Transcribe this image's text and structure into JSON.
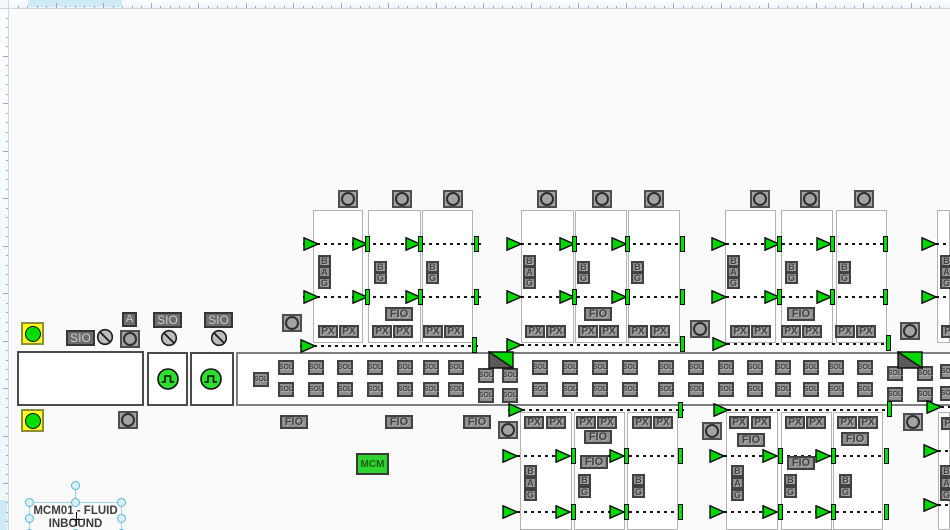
{
  "texts": {
    "sio": "SIO",
    "px": "PX",
    "fio": "FIO",
    "sol": "SOL",
    "mcm": "MCM",
    "a": "A"
  },
  "selected_label": {
    "line1": "MCM01 - FLUID",
    "line2": "INBOUND"
  },
  "colors": {
    "valve_green": "#00d600",
    "bar_green": "#00e000",
    "indicator_yellow": "#ffff1a",
    "box_gray": "#8f8f8f",
    "box_dark": "#414141",
    "ruler_highlight": "#cfe9f7",
    "selection_blue": "#58b7da",
    "mcm_green": "#2fd32f"
  },
  "diagram": {
    "band": [
      236,
      352,
      714,
      54
    ],
    "boxes": [
      [
        17,
        351,
        127,
        55
      ],
      [
        147,
        352,
        41,
        54
      ],
      [
        190,
        352,
        44,
        54
      ]
    ],
    "panels": [
      [
        313,
        210,
        50,
        133
      ],
      [
        368,
        210,
        53,
        133
      ],
      [
        422,
        210,
        51,
        133
      ],
      [
        521,
        210,
        53,
        133
      ],
      [
        575,
        210,
        52,
        133
      ],
      [
        628,
        210,
        52,
        133
      ],
      [
        725,
        210,
        51,
        133
      ],
      [
        781,
        210,
        52,
        133
      ],
      [
        836,
        210,
        51,
        133
      ],
      [
        937,
        210,
        13,
        133
      ],
      [
        520,
        412,
        52,
        118
      ],
      [
        574,
        412,
        51,
        118
      ],
      [
        627,
        412,
        51,
        118
      ],
      [
        726,
        412,
        52,
        118
      ],
      [
        781,
        412,
        51,
        118
      ],
      [
        833,
        412,
        50,
        118
      ],
      [
        938,
        412,
        12,
        118
      ]
    ],
    "dashes": [
      [
        303,
        243,
        178
      ],
      [
        303,
        296,
        178
      ],
      [
        300,
        345,
        180
      ],
      [
        507,
        243,
        178
      ],
      [
        507,
        296,
        178
      ],
      [
        507,
        344,
        178
      ],
      [
        712,
        243,
        176
      ],
      [
        712,
        296,
        176
      ],
      [
        713,
        343,
        177
      ],
      [
        922,
        243,
        28
      ],
      [
        922,
        296,
        28
      ],
      [
        508,
        409,
        176
      ],
      [
        503,
        455,
        180
      ],
      [
        503,
        511,
        180
      ],
      [
        714,
        409,
        178
      ],
      [
        710,
        455,
        180
      ],
      [
        710,
        511,
        180
      ],
      [
        927,
        406,
        23
      ],
      [
        924,
        450,
        26
      ],
      [
        924,
        504,
        26
      ]
    ],
    "triangles": [
      [
        303,
        237
      ],
      [
        352,
        237
      ],
      [
        405,
        237
      ],
      [
        303,
        290
      ],
      [
        352,
        290
      ],
      [
        405,
        290
      ],
      [
        300,
        339
      ],
      [
        506,
        237
      ],
      [
        559,
        237
      ],
      [
        611,
        237
      ],
      [
        506,
        290
      ],
      [
        559,
        290
      ],
      [
        611,
        290
      ],
      [
        506,
        338
      ],
      [
        711,
        237
      ],
      [
        764,
        237
      ],
      [
        816,
        237
      ],
      [
        711,
        290
      ],
      [
        764,
        290
      ],
      [
        816,
        290
      ],
      [
        712,
        337
      ],
      [
        921,
        237
      ],
      [
        921,
        290
      ],
      [
        508,
        403
      ],
      [
        502,
        449
      ],
      [
        555,
        449
      ],
      [
        609,
        449
      ],
      [
        502,
        505
      ],
      [
        555,
        505
      ],
      [
        609,
        505
      ],
      [
        713,
        403
      ],
      [
        709,
        449
      ],
      [
        762,
        449
      ],
      [
        815,
        449
      ],
      [
        709,
        505
      ],
      [
        762,
        505
      ],
      [
        815,
        505
      ],
      [
        926,
        400
      ],
      [
        923,
        444
      ],
      [
        923,
        498
      ]
    ],
    "bars": [
      [
        365,
        236
      ],
      [
        418,
        236
      ],
      [
        474,
        236
      ],
      [
        365,
        289
      ],
      [
        418,
        289
      ],
      [
        474,
        289
      ],
      [
        472,
        337
      ],
      [
        572,
        236
      ],
      [
        625,
        236
      ],
      [
        680,
        236
      ],
      [
        572,
        289
      ],
      [
        625,
        289
      ],
      [
        680,
        289
      ],
      [
        680,
        336
      ],
      [
        777,
        236
      ],
      [
        830,
        236
      ],
      [
        883,
        236
      ],
      [
        777,
        289
      ],
      [
        830,
        289
      ],
      [
        883,
        289
      ],
      [
        886,
        335
      ],
      [
        571,
        448
      ],
      [
        624,
        448
      ],
      [
        678,
        448
      ],
      [
        571,
        504
      ],
      [
        624,
        504
      ],
      [
        678,
        504
      ],
      [
        678,
        402
      ],
      [
        778,
        448
      ],
      [
        831,
        448
      ],
      [
        884,
        448
      ],
      [
        778,
        504
      ],
      [
        831,
        504
      ],
      [
        884,
        504
      ],
      [
        887,
        401
      ]
    ],
    "circle_boxes": [
      [
        338,
        190
      ],
      [
        392,
        190
      ],
      [
        443,
        190
      ],
      [
        537,
        190
      ],
      [
        592,
        190
      ],
      [
        644,
        190
      ],
      [
        750,
        190
      ],
      [
        800,
        190
      ],
      [
        854,
        190
      ],
      [
        282,
        314
      ],
      [
        690,
        320
      ],
      [
        900,
        322
      ],
      [
        498,
        421
      ],
      [
        702,
        422
      ],
      [
        903,
        413
      ],
      [
        120,
        330
      ],
      [
        118,
        411
      ]
    ],
    "crossed_circles": [
      [
        96,
        328
      ],
      [
        160,
        329
      ],
      [
        210,
        329
      ]
    ],
    "yellow_indicators": [
      [
        21,
        322
      ],
      [
        21,
        409
      ]
    ],
    "pulse_indicators": [
      [
        156,
        367
      ],
      [
        199,
        367
      ]
    ],
    "flags": [
      [
        488,
        351
      ],
      [
        897,
        351
      ]
    ],
    "sio_boxes": [
      [
        66,
        330
      ],
      [
        153,
        312
      ],
      [
        204,
        312
      ]
    ],
    "a_boxes": [
      [
        122,
        312
      ]
    ],
    "mcm_boxes": [
      [
        356,
        453
      ]
    ],
    "px_boxes": [
      [
        318,
        325
      ],
      [
        339,
        325
      ],
      [
        372,
        325
      ],
      [
        393,
        325
      ],
      [
        423,
        325
      ],
      [
        444,
        325
      ],
      [
        525,
        325
      ],
      [
        546,
        325
      ],
      [
        578,
        325
      ],
      [
        599,
        325
      ],
      [
        628,
        325
      ],
      [
        650,
        325
      ],
      [
        730,
        325
      ],
      [
        751,
        325
      ],
      [
        781,
        325
      ],
      [
        802,
        325
      ],
      [
        835,
        325
      ],
      [
        856,
        325
      ],
      [
        941,
        325
      ],
      [
        524,
        416
      ],
      [
        546,
        416
      ],
      [
        576,
        416
      ],
      [
        597,
        416
      ],
      [
        632,
        416
      ],
      [
        653,
        416
      ],
      [
        729,
        416
      ],
      [
        751,
        416
      ],
      [
        785,
        416
      ],
      [
        806,
        416
      ],
      [
        837,
        416
      ],
      [
        858,
        416
      ],
      [
        941,
        417
      ]
    ],
    "fio_boxes": [
      [
        385,
        307
      ],
      [
        584,
        307
      ],
      [
        787,
        307
      ],
      [
        584,
        430
      ],
      [
        580,
        455
      ],
      [
        737,
        433
      ],
      [
        841,
        432
      ],
      [
        787,
        456
      ],
      [
        280,
        415
      ],
      [
        385,
        415
      ],
      [
        463,
        415
      ]
    ],
    "sol_boxes": [
      [
        253,
        372
      ],
      [
        278,
        360
      ],
      [
        278,
        382
      ],
      [
        308,
        360
      ],
      [
        308,
        382
      ],
      [
        337,
        360
      ],
      [
        337,
        382
      ],
      [
        367,
        360
      ],
      [
        367,
        382
      ],
      [
        397,
        360
      ],
      [
        397,
        382
      ],
      [
        423,
        360
      ],
      [
        423,
        382
      ],
      [
        448,
        360
      ],
      [
        448,
        382
      ],
      [
        478,
        368
      ],
      [
        478,
        388
      ],
      [
        502,
        368
      ],
      [
        502,
        388
      ],
      [
        532,
        360
      ],
      [
        532,
        382
      ],
      [
        562,
        360
      ],
      [
        562,
        382
      ],
      [
        592,
        360
      ],
      [
        592,
        382
      ],
      [
        622,
        360
      ],
      [
        622,
        382
      ],
      [
        658,
        360
      ],
      [
        658,
        382
      ],
      [
        688,
        360
      ],
      [
        688,
        382
      ],
      [
        718,
        360
      ],
      [
        718,
        382
      ],
      [
        747,
        360
      ],
      [
        747,
        382
      ],
      [
        775,
        360
      ],
      [
        775,
        382
      ],
      [
        803,
        360
      ],
      [
        803,
        382
      ],
      [
        828,
        360
      ],
      [
        828,
        382
      ],
      [
        857,
        360
      ],
      [
        857,
        382
      ],
      [
        887,
        366
      ],
      [
        887,
        387
      ],
      [
        917,
        366
      ],
      [
        917,
        387
      ],
      [
        940,
        364
      ],
      [
        940,
        386
      ]
    ],
    "letters": [
      [
        318,
        255,
        "B"
      ],
      [
        318,
        266,
        "A"
      ],
      [
        318,
        277,
        "G"
      ],
      [
        374,
        261,
        "B"
      ],
      [
        374,
        272,
        "G"
      ],
      [
        426,
        261,
        "B"
      ],
      [
        426,
        272,
        "G"
      ],
      [
        523,
        255,
        "B"
      ],
      [
        523,
        266,
        "A"
      ],
      [
        523,
        277,
        "G"
      ],
      [
        577,
        261,
        "B"
      ],
      [
        577,
        272,
        "G"
      ],
      [
        631,
        261,
        "B"
      ],
      [
        631,
        272,
        "G"
      ],
      [
        727,
        255,
        "B"
      ],
      [
        727,
        266,
        "A"
      ],
      [
        727,
        277,
        "G"
      ],
      [
        785,
        261,
        "B"
      ],
      [
        785,
        272,
        "G"
      ],
      [
        838,
        261,
        "B"
      ],
      [
        838,
        272,
        "G"
      ],
      [
        940,
        255,
        "B"
      ],
      [
        940,
        266,
        "A"
      ],
      [
        940,
        277,
        "G"
      ],
      [
        524,
        465,
        "B"
      ],
      [
        524,
        477,
        "A"
      ],
      [
        524,
        489,
        "G"
      ],
      [
        578,
        474,
        "B"
      ],
      [
        578,
        486,
        "G"
      ],
      [
        632,
        474,
        "B"
      ],
      [
        632,
        486,
        "G"
      ],
      [
        731,
        465,
        "B"
      ],
      [
        731,
        477,
        "A"
      ],
      [
        731,
        489,
        "G"
      ],
      [
        784,
        474,
        "B"
      ],
      [
        784,
        486,
        "G"
      ],
      [
        839,
        474,
        "B"
      ],
      [
        839,
        486,
        "G"
      ],
      [
        940,
        465,
        "B"
      ],
      [
        940,
        477,
        "A"
      ],
      [
        940,
        489,
        "G"
      ]
    ]
  }
}
